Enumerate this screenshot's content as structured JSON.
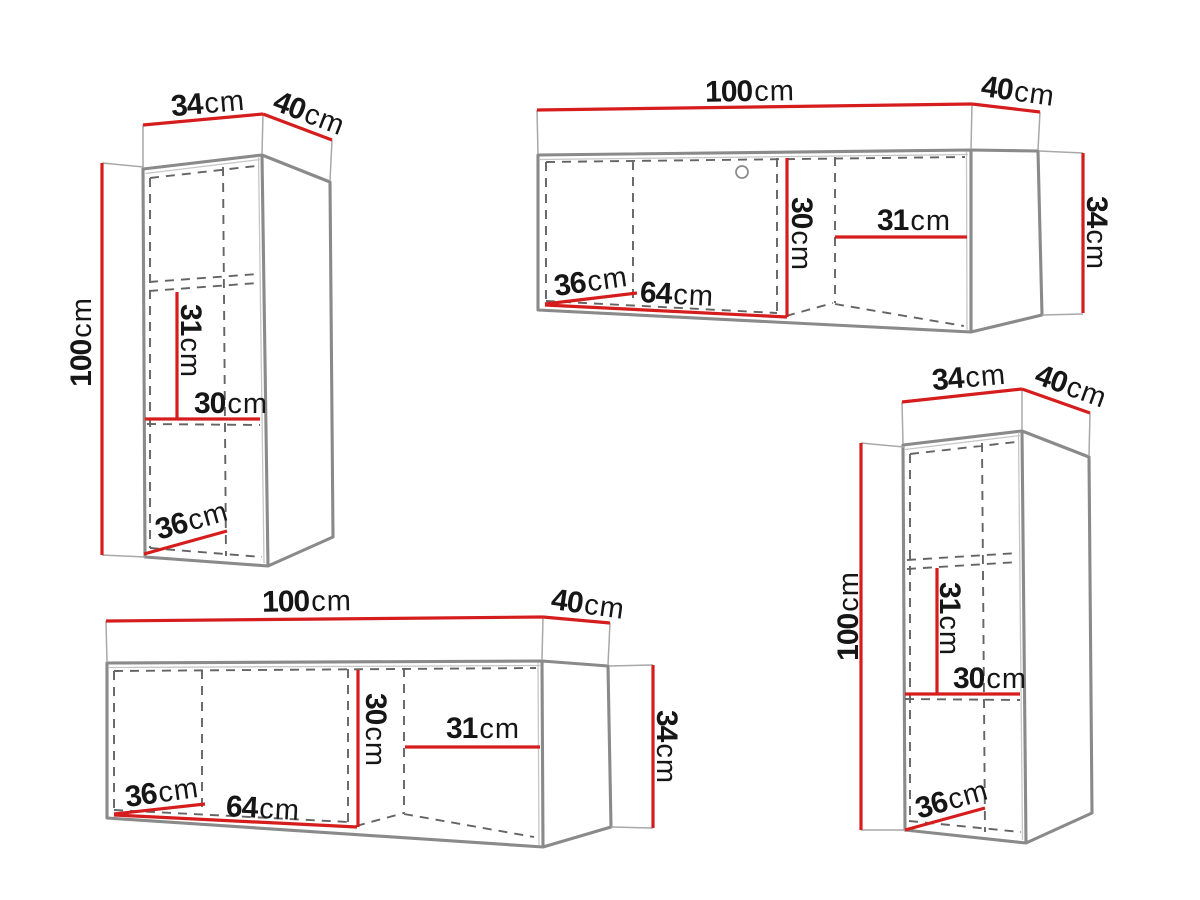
{
  "diagram_title": "Hanging wall cabinets dimension drawings",
  "unit": "cm",
  "colors": {
    "c-red": "#d61d1d",
    "c-outline": "#8a8a8a",
    "c-outline-light": "#c6c6c6",
    "c-ext": "#a8a8a8",
    "c-dash": "#646464",
    "c-ink": "#161616",
    "c-bg": "#ffffff"
  },
  "cabinets": [
    {
      "id": "tall-cabinet-top-left",
      "labels": {
        "width": {
          "v": "34",
          "u": "cm"
        },
        "depth": {
          "v": "40",
          "u": "cm"
        },
        "height": {
          "v": "100",
          "u": "cm"
        },
        "shelf_spacing": {
          "v": "31",
          "u": "cm"
        },
        "inner_width": {
          "v": "30",
          "u": "cm"
        },
        "bottom_depth": {
          "v": "36",
          "u": "cm"
        }
      }
    },
    {
      "id": "wide-cabinet-top-right",
      "labels": {
        "width": {
          "v": "100",
          "u": "cm"
        },
        "depth": {
          "v": "40",
          "u": "cm"
        },
        "height": {
          "v": "34",
          "u": "cm"
        },
        "inner_height": {
          "v": "30",
          "u": "cm"
        },
        "right_section_width": {
          "v": "31",
          "u": "cm"
        },
        "bottom_depth": {
          "v": "36",
          "u": "cm"
        },
        "left_section_length": {
          "v": "64",
          "u": "cm"
        }
      }
    },
    {
      "id": "wide-cabinet-bottom-left",
      "labels": {
        "width": {
          "v": "100",
          "u": "cm"
        },
        "depth": {
          "v": "40",
          "u": "cm"
        },
        "height": {
          "v": "34",
          "u": "cm"
        },
        "inner_height": {
          "v": "30",
          "u": "cm"
        },
        "right_section_width": {
          "v": "31",
          "u": "cm"
        },
        "bottom_depth": {
          "v": "36",
          "u": "cm"
        },
        "left_section_length": {
          "v": "64",
          "u": "cm"
        }
      }
    },
    {
      "id": "tall-cabinet-bottom-right",
      "labels": {
        "width": {
          "v": "34",
          "u": "cm"
        },
        "depth": {
          "v": "40",
          "u": "cm"
        },
        "height": {
          "v": "100",
          "u": "cm"
        },
        "shelf_spacing": {
          "v": "31",
          "u": "cm"
        },
        "inner_width": {
          "v": "30",
          "u": "cm"
        },
        "bottom_depth": {
          "v": "36",
          "u": "cm"
        }
      }
    }
  ]
}
